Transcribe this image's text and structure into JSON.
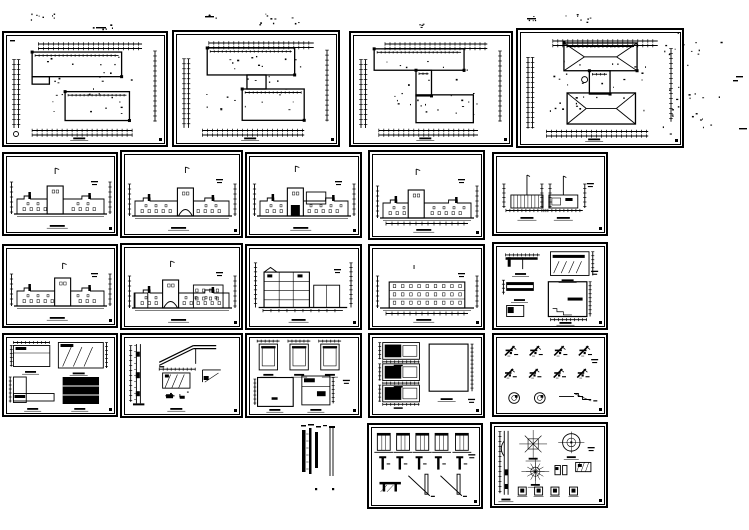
{
  "page": {
    "description": "Set of black-and-white architectural CAD drawings: floor plans, elevations, sections and construction details arranged in a grid on a white background",
    "ink": "#000000",
    "paper": "#ffffff"
  },
  "sheets": [
    {
      "name": "first-floor-plan",
      "type": "plan",
      "variant": 1,
      "x": 2,
      "y": 31,
      "w": 166,
      "h": 116
    },
    {
      "name": "second-floor-plan",
      "type": "plan",
      "variant": 2,
      "x": 172,
      "y": 30,
      "w": 168,
      "h": 117
    },
    {
      "name": "third-floor-plan",
      "type": "plan",
      "variant": 3,
      "x": 349,
      "y": 31,
      "w": 164,
      "h": 116
    },
    {
      "name": "roof-plan",
      "type": "plan",
      "variant": 4,
      "x": 516,
      "y": 28,
      "w": 168,
      "h": 120
    },
    {
      "name": "elevation-1",
      "type": "elevation",
      "variant": 1,
      "x": 2,
      "y": 152,
      "w": 116,
      "h": 84
    },
    {
      "name": "elevation-2",
      "type": "elevation",
      "variant": 2,
      "x": 120,
      "y": 150,
      "w": 123,
      "h": 88
    },
    {
      "name": "elevation-3",
      "type": "elevation",
      "variant": 3,
      "x": 245,
      "y": 152,
      "w": 117,
      "h": 86
    },
    {
      "name": "elevation-4",
      "type": "elevation",
      "variant": 4,
      "x": 368,
      "y": 150,
      "w": 117,
      "h": 90
    },
    {
      "name": "gable-sections",
      "type": "gables",
      "variant": 1,
      "x": 492,
      "y": 152,
      "w": 116,
      "h": 84
    },
    {
      "name": "elevation-5",
      "type": "elevation",
      "variant": 5,
      "x": 2,
      "y": 244,
      "w": 116,
      "h": 84
    },
    {
      "name": "elevation-6",
      "type": "elevation",
      "variant": 6,
      "x": 120,
      "y": 243,
      "w": 123,
      "h": 87
    },
    {
      "name": "building-section",
      "type": "section",
      "variant": 1,
      "x": 245,
      "y": 244,
      "w": 117,
      "h": 86
    },
    {
      "name": "side-elevation",
      "type": "elevation",
      "variant": 7,
      "x": 368,
      "y": 244,
      "w": 117,
      "h": 86
    },
    {
      "name": "stair-sections",
      "type": "blackdetails",
      "variant": 1,
      "x": 492,
      "y": 242,
      "w": 116,
      "h": 88
    },
    {
      "name": "wall-details",
      "type": "details1",
      "variant": 1,
      "x": 2,
      "y": 333,
      "w": 116,
      "h": 84
    },
    {
      "name": "stair-wall-details",
      "type": "details2",
      "variant": 1,
      "x": 120,
      "y": 333,
      "w": 123,
      "h": 85
    },
    {
      "name": "frame-details",
      "type": "details3",
      "variant": 1,
      "x": 245,
      "y": 333,
      "w": 117,
      "h": 85
    },
    {
      "name": "window-stair-details",
      "type": "details4",
      "variant": 1,
      "x": 368,
      "y": 333,
      "w": 117,
      "h": 85
    },
    {
      "name": "eave-details",
      "type": "details5",
      "variant": 1,
      "x": 492,
      "y": 333,
      "w": 116,
      "h": 84
    },
    {
      "name": "wall-legend-strip",
      "type": "legend",
      "variant": 1,
      "x": 300,
      "y": 424,
      "w": 50,
      "h": 72,
      "frameless": true
    },
    {
      "name": "misc-details",
      "type": "details6",
      "variant": 1,
      "x": 367,
      "y": 423,
      "w": 116,
      "h": 86
    },
    {
      "name": "tower-plan-details",
      "type": "towerplans",
      "variant": 1,
      "x": 490,
      "y": 422,
      "w": 118,
      "h": 86
    }
  ],
  "decor": {
    "speck_clusters": [
      {
        "x": 28,
        "y": 13,
        "w": 30,
        "h": 11,
        "n": 8
      },
      {
        "x": 92,
        "y": 24,
        "w": 22,
        "h": 5,
        "n": 5
      },
      {
        "x": 200,
        "y": 14,
        "w": 16,
        "h": 5,
        "n": 4
      },
      {
        "x": 252,
        "y": 12,
        "w": 50,
        "h": 14,
        "n": 10
      },
      {
        "x": 405,
        "y": 23,
        "w": 18,
        "h": 5,
        "n": 4
      },
      {
        "x": 522,
        "y": 15,
        "w": 16,
        "h": 6,
        "n": 4
      },
      {
        "x": 564,
        "y": 12,
        "w": 30,
        "h": 11,
        "n": 7
      },
      {
        "x": 660,
        "y": 32,
        "w": 62,
        "h": 102,
        "n": 32
      }
    ],
    "dashes": [
      {
        "x": 736,
        "y": 76,
        "w": 7
      },
      {
        "x": 733,
        "y": 80,
        "w": 5
      },
      {
        "x": 739,
        "y": 128,
        "w": 8
      },
      {
        "x": 10,
        "y": 40,
        "w": 5
      },
      {
        "x": 96,
        "y": 27,
        "w": 10
      },
      {
        "x": 205,
        "y": 16,
        "w": 9
      },
      {
        "x": 527,
        "y": 18,
        "w": 9
      }
    ]
  }
}
